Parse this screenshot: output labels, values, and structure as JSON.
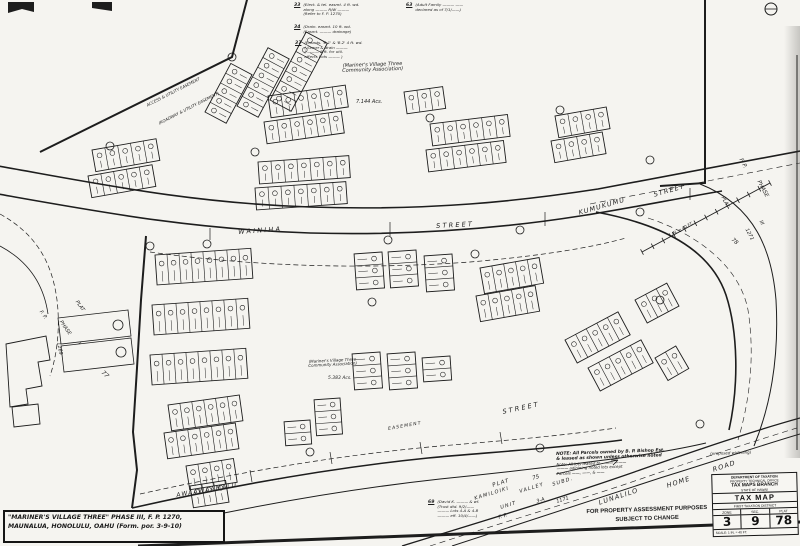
{
  "title_box": {
    "line1": "\"MARINER'S VILLAGE THREE\" PHASE III, F. P. 1270,",
    "line2": "MAUNALUA, HONOLULU, OAHU (Form. por. 3-9-10)"
  },
  "title_block": {
    "dept": "DEPARTMENT OF TAXATION",
    "office": "PROPERTY TECHNICAL OFFICE",
    "branch": "TAX MAPS BRANCH",
    "state": "STATE OF HAWAII",
    "map": "TAX MAP",
    "district": "FIRST TAXATION DISTRICT",
    "zone_label": "ZONE",
    "sec_label": "SEC.",
    "plat_label": "PLAT",
    "zone": "3",
    "sec": "9",
    "plat": "78",
    "scale": "SCALE: 1 IN. = 40 FT."
  },
  "disclaimer": {
    "line1": "FOR PROPERTY ASSESSMENT PURPOSES",
    "line2": "SUBJECT TO CHANGE"
  },
  "streets": {
    "wainiha": "WAINIHA",
    "street1": "STREET",
    "kumukumu": "KUMUKUMU",
    "street2": "STREET",
    "awaawaamalu": "AWAAWAAMALU",
    "street3": "STREET",
    "lunalilo": "LUNALILO",
    "home": "HOME",
    "road": "ROAD",
    "easement": "EASEMENT"
  },
  "areas": {
    "assoc_top1": "(Mariner's Village Three",
    "assoc_top2": "Community Association)",
    "acre_top": "7.144 Acs.",
    "assoc_low1": "(Mariner's Village Three",
    "assoc_low2": "Community Association)",
    "acre_low": "5.383 Acs."
  },
  "adjacent": {
    "fp_right": "F.  P.",
    "phase_right": "PHASE",
    "phase_right_no": "III",
    "plat_right": "PLAT",
    "num_right": "1271",
    "plat78": "78",
    "plat_left": "PLAT",
    "phase_left": "PHASE",
    "fp_left": "F. P.",
    "num_left": "1269",
    "phase_left_no": "I",
    "plat77": "77",
    "plat_b1": "PLAT",
    "plat_b2": "75",
    "kam1": "KAMILOIKI",
    "kam2": "VALLEY",
    "kam3": "SUBD.",
    "unit": "UNIT",
    "unit_no": "3-A",
    "fp_b": "F.  P.",
    "fp_b_no": "1171"
  },
  "notes": {
    "n33": {
      "no": "33",
      "lines": [
        "(Elect. & tel. easmt. 4 ft. wd.",
        "along ——— R/W ———",
        "(Refer to F. P. 1270)"
      ]
    },
    "n34": {
      "no": "34",
      "lines": [
        "(Drain. easmt. 10 ft. wd.",
        "(Easmt. ——— drainage)"
      ]
    },
    "n37": {
      "no": "37",
      "lines": [
        "(Easmts. 'B-1' & 'B-2' 4 ft. wd.",
        "( Sewer & drain ———",
        "( ——— 8 ft. for util.",
        "affects Lots ——— )"
      ]
    },
    "n63": {
      "no": "63",
      "lines": [
        "(Adult Family ——— ——",
        "declared as of 7/1/——)"
      ]
    },
    "n69": {
      "no": "69",
      "lines": [
        "(David K. ——— & wf.",
        "(Trust dtd. 9/2/——",
        "——— Lots 4-A & 4-B",
        "——— eff. 10/4/——)"
      ]
    },
    "bp1": {
      "lines": [
        "NOTE:  All Parcels owned by B. P. Bishop Est.",
        "& leased as shown unless otherwise noted"
      ]
    },
    "bp2": {
      "lines": [
        "Note:  All lots leased to ——— ———",
        "——— adjoining noted lots except",
        "Parcels ——, ——, & ——"
      ]
    },
    "widening": "(proposed widening)",
    "hatch_note": "1 IN. = 40 FT.",
    "e1": "ACCESS & UTILITY EASEMENT",
    "e2": "(ROADWAY & UTILITY EASEMENT)"
  }
}
